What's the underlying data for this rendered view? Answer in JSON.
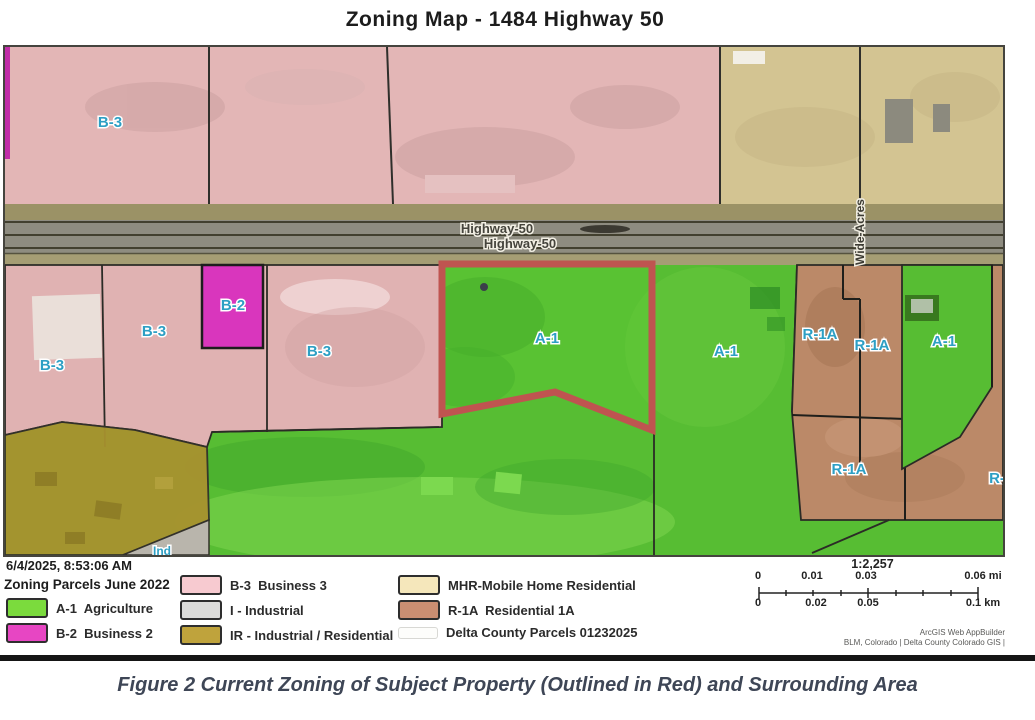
{
  "page": {
    "title": "Zoning Map - 1484 Highway 50",
    "caption": "Figure 2 Current Zoning of Subject Property (Outlined in Red) and Surrounding Area"
  },
  "map": {
    "labels": {
      "b3_top": "B-3",
      "b3_left": "B-3",
      "b3_mid": "B-3",
      "b3_right": "B-3",
      "b2": "B-2",
      "a1_subject": "A-1",
      "a1_east": "A-1",
      "a1_far_east": "A-1",
      "r1a_west": "R-1A",
      "r1a_mid": "R-1A",
      "r1a_south": "R-1A",
      "r1a_edge": "R-",
      "ind": "Ind",
      "highway_1": "Highway-50",
      "highway_2": "Highway-50",
      "street": "Wide-Acres"
    },
    "colors": {
      "subject_outline": "#bf5450",
      "agriculture_green": "#57bd33",
      "business2_magenta": "#d936bd",
      "business3_pink": "#e0b2b2",
      "residential1a_brown": "#bb8968",
      "industrial_gray": "#c3c1b8",
      "ir_gold": "#a8922f",
      "unzoned_tan": "#d3c492",
      "road_gray": "#8e8c80"
    }
  },
  "legend": {
    "timestamp": "6/4/2025, 8:53:06 AM",
    "layer_title": "Zoning Parcels June 2022",
    "items": {
      "a1": {
        "label": "A-1  Agriculture",
        "color": "#7bdb3d"
      },
      "b2": {
        "label": "B-2  Business 2",
        "color": "#e746c3"
      },
      "b3": {
        "label": "B-3  Business 3",
        "color": "#f7cad0"
      },
      "i": {
        "label": "I - Industrial",
        "color": "#dcdcda"
      },
      "ir": {
        "label": "IR - Industrial / Residential",
        "color": "#bfa33c"
      },
      "mhr": {
        "label": "MHR-Mobile Home Residential",
        "color": "#f5e7bb"
      },
      "r1a": {
        "label": "R-1A  Residential 1A",
        "color": "#ca8e72"
      },
      "parcels": {
        "label": "Delta County Parcels 01232025"
      }
    }
  },
  "scalebar": {
    "ratio": "1:2,257",
    "mi": {
      "t0": "0",
      "t1": "0.01",
      "t2": "0.03",
      "t3": "0.06 mi"
    },
    "km": {
      "t0": "0",
      "t1": "0.02",
      "t2": "0.05",
      "t3": "0.1 km"
    }
  },
  "attribution": {
    "line1": "ArcGIS Web AppBuilder",
    "line2": "BLM, Colorado | Delta County Colorado GIS |"
  }
}
